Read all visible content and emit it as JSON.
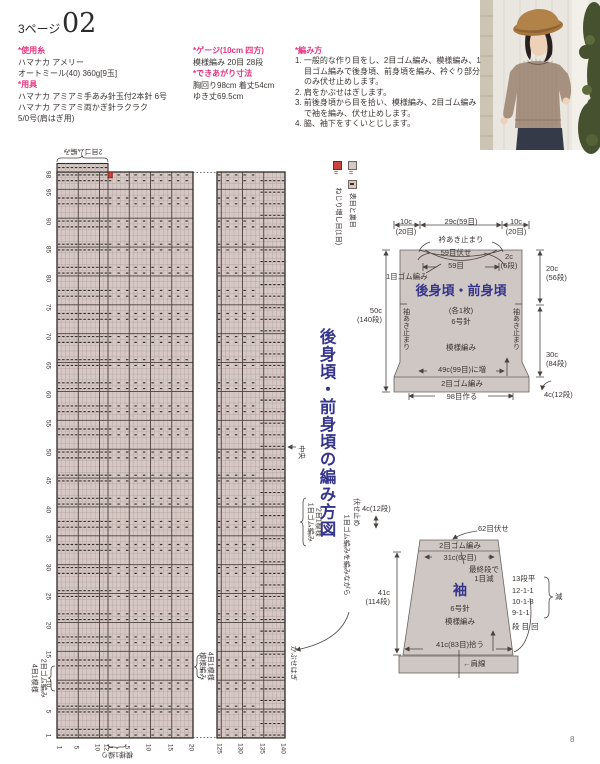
{
  "page": {
    "header": "3ページ",
    "number": "02",
    "footer": "8"
  },
  "info": {
    "yarn_header": "*使用糸",
    "yarn_lines": [
      "ハマナカ アメリー",
      "オートミール(40) 360g[9玉]"
    ],
    "tools_header": "*用具",
    "tools_lines": [
      "ハマナカ アミアミ手あみ針玉付2本針 6号",
      "ハマナカ アミアミ両かぎ針ラクラク",
      "5/0号(肩はぎ用)"
    ],
    "gauge_header": "*ゲージ(10cm 四方)",
    "gauge_line": "模様編み 20目 28段",
    "size_header": "*できあがり寸法",
    "size_lines": [
      "胸回り98cm 着丈54cm",
      "ゆき丈69.5cm"
    ],
    "howto_header": "*編み方",
    "steps": [
      "1. 一般的な作り目をし、2目ゴム編み、模様編み、1目ゴム編みで後身頃、前身頃を編み、衿ぐり部分のみ伏せ止めします。",
      "2. 肩をかぶせはぎします。",
      "3. 前後身頃から目を拾い、模様編み、2目ゴム編みで袖を編み、伏せ止めします。",
      "4. 脇、袖下をすくいとじします。"
    ]
  },
  "legend": {
    "equals1": "=",
    "increase": "ねじり増し目(1目)",
    "equals2": "=",
    "stitches": "表目と裏目"
  },
  "chart": {
    "title": "後身頃・前身頃の編み方図",
    "top_rib_label": "2目ゴム編み",
    "left_rib_label": "2目ゴム編み",
    "left_rib_repeat": "4目1模様",
    "mid_pattern_label": "模様編み",
    "mid_pattern_repeat": "4目1模様",
    "bottom_repeat_label": "模様1繰り",
    "center_label": "中央",
    "top_band_label": "1目ゴム編み",
    "top_band_repeat": "2目1模様",
    "bindoff_label": "1目ゴム編みを編みながら",
    "bindoff_label2": "伏せ止め",
    "shoulder_label": "かぶせはぎ",
    "axis": {
      "rows": [
        "98",
        "95",
        "90",
        "85",
        "80",
        "75",
        "70",
        "65",
        "60",
        "55",
        "50",
        "45",
        "40",
        "35",
        "30",
        "25",
        "20",
        "15",
        "10",
        "5",
        "1"
      ],
      "rib_cols": [
        "1",
        "5",
        "10",
        "12"
      ],
      "pattern_cols": [
        "1",
        "5",
        "10",
        "15",
        "20"
      ],
      "pattern_cols2": [
        "125",
        "130",
        "135",
        "140"
      ]
    }
  },
  "body_diagram": {
    "width_left": "10c",
    "width_left2": "(20目)",
    "width_mid": "29c(59目)",
    "width_right": "10c",
    "width_right2": "(20目)",
    "neck_open": "衿あき止まり",
    "neck_bindoff": "59目伏せ",
    "neck_sts": "59目",
    "neck_depth": "2c\n(6段)",
    "neck_band": "1目ゴム編み",
    "title": "後身頃・前身頃",
    "pieces": "(各1枚)",
    "needle": "6号針",
    "stitch": "模様編み",
    "height_left": "50c\n(140段)",
    "armhole_left": "袖あき止まり",
    "armhole_right": "袖あき止まり",
    "height_top_right": "20c\n(56段)",
    "height_bottom_right": "30c\n(84段)",
    "hem_height": "4c(12段)",
    "hem_inc": "49c(99目)に増",
    "hem_band": "2目ゴム編み",
    "cast_on": "98目作る"
  },
  "sleeve_diagram": {
    "band_height": "4c(12段)",
    "bindoff": "62目伏せ",
    "band": "2目ゴム編み",
    "top_width": "31c(62目)",
    "final_dec": "最終段で\n1目減",
    "title": "袖",
    "needle": "6号針",
    "stitch": "模様編み",
    "height": "41c\n(114段)",
    "dec_schedule": [
      "13段平",
      "12-1-1",
      "10-1-8",
      "9-1-1"
    ],
    "dec_cols": "段 目 回",
    "dec_label": "減",
    "pickup": "41c(83目)拾う",
    "shoulder_line": "←肩線"
  }
}
